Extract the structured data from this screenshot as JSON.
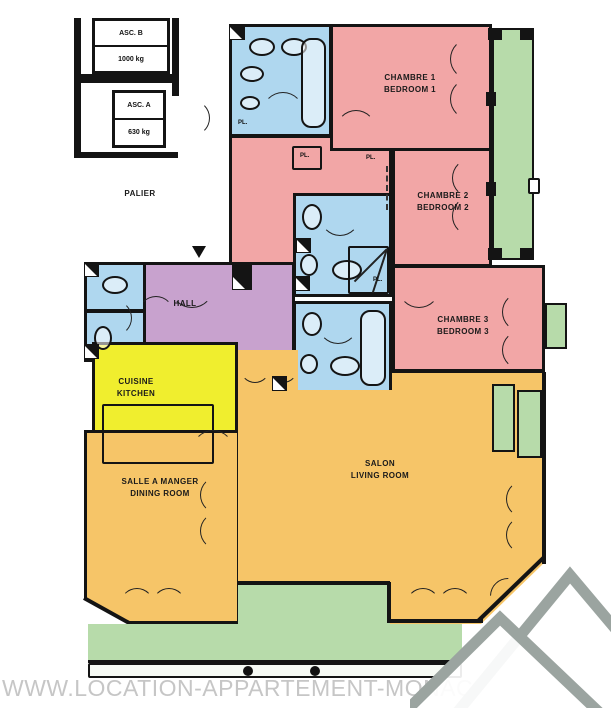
{
  "watermark": "WWW.LOCATION-APPARTEMENT-MONACO.COM",
  "elevators": {
    "b": {
      "name": "ASC. B",
      "capacity": "1000 kg"
    },
    "a": {
      "name": "ASC. A",
      "capacity": "630 kg"
    }
  },
  "landing": {
    "label": "PALIER"
  },
  "rooms": {
    "bedroom1": {
      "fr": "CHAMBRE 1",
      "en": "BEDROOM 1"
    },
    "bedroom2": {
      "fr": "CHAMBRE 2",
      "en": "BEDROOM 2"
    },
    "bedroom3": {
      "fr": "CHAMBRE 3",
      "en": "BEDROOM 3"
    },
    "hall": {
      "fr": "HALL"
    },
    "kitchen": {
      "fr": "CUISINE",
      "en": "KITCHEN"
    },
    "dining": {
      "fr": "SALLE A MANGER",
      "en": "DINING ROOM"
    },
    "living": {
      "fr": "SALON",
      "en": "LIVING ROOM"
    }
  },
  "labels": {
    "closet": "PL."
  },
  "colors": {
    "bedroom": "#F2A6A6",
    "bathroom": "#AFD7EF",
    "hall": "#C8A2CE",
    "kitchen": "#F0EE2E",
    "living": "#F6C568",
    "terrace": "#B7DBAA",
    "walls": "#141414",
    "watermark": "#C6C6C6",
    "logo": "#9BA4A0"
  }
}
